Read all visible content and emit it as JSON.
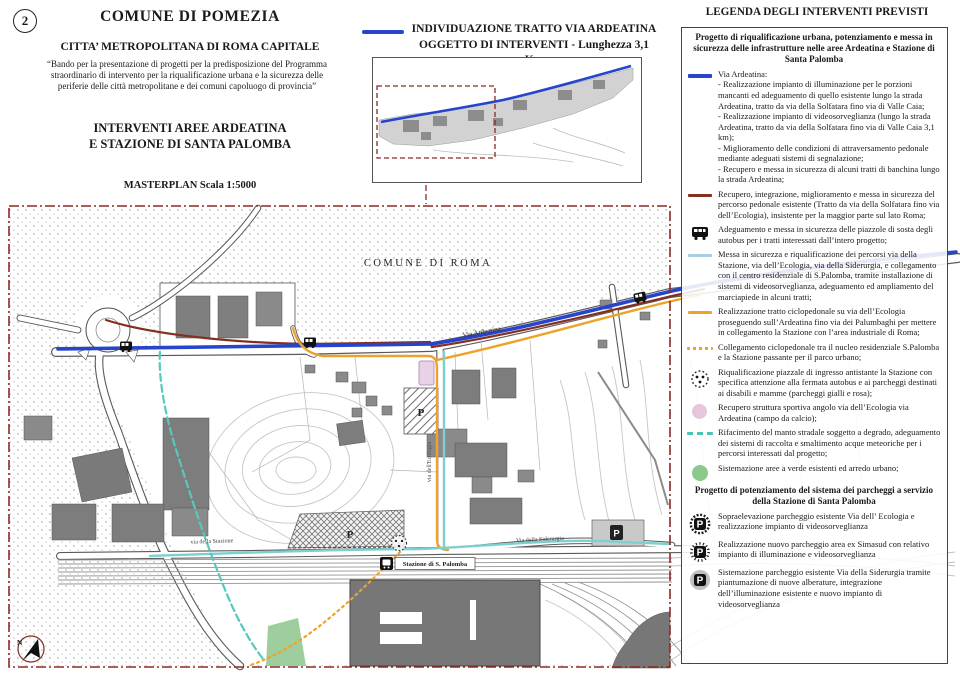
{
  "page": {
    "sheet_number": "2"
  },
  "title_block": {
    "title": "COMUNE DI POMEZIA",
    "subtitle": "CITTA’ METROPOLITANA DI ROMA CAPITALE",
    "quote": "“Bando per la presentazione di progetti per la predisposizione del Programma straordinario di intervento per la riqualificazione urbana e la sicurezza delle periferie delle città metropolitane e dei comuni capoluogo di provincia”",
    "heading_line1": "INTERVENTI  AREE ARDEATINA",
    "heading_line2": "E STAZIONE DI SANTA PALOMBA",
    "masterplan": "MASTERPLAN Scala 1:5000"
  },
  "inset": {
    "heading_line1": "INDIVIDUAZIONE TRATTO  VIA ARDEATINA",
    "heading_line2": "OGGETTO DI INTERVENTI - Lunghezza 3,1 Km"
  },
  "map_labels": {
    "comune_roma": "COMUNE DI ROMA",
    "via_ardeatina": "Via Ardeatina",
    "via_ecologia": "via dell'Ecologia",
    "via_siderurgia": "Via della Siderurgia",
    "via_stazione": "via della Stazione",
    "station": "Stazione di S. Palomba",
    "north": "N",
    "parking_p1": "P",
    "parking_p2": "P",
    "parking_p3": "P"
  },
  "legend": {
    "title": "LEGENDA DEGLI INTERVENTI PREVISTI",
    "section1_title": "Progetto di riqualificazione urbana, potenziamento e messa in sicurezza delle infrastrutture nelle aree Ardeatina e Stazione di Santa Palomba",
    "items": [
      {
        "icon": "blue-line",
        "label": "Via Ardeatina:",
        "subs": [
          "- Realizzazione impianto di illuminazione per le porzioni mancanti ed adeguamento di quello esistente lungo la strada Ardeatina, tratto da via della Solfatara fino via di Valle Caia;",
          "- Realizzazione impianto di videosorveglianza (lungo la strada Ardeatina, tratto da via della Solfatara fino via di Valle Caia 3,1 km);",
          "- Miglioramento delle condizioni di attraversamento pedonale mediante adeguati sistemi di segnalazione;",
          "- Recupero e messa in sicurezza di alcuni tratti di banchina lungo la strada Ardeatina;"
        ]
      },
      {
        "icon": "darkred-line",
        "text": "Recupero, integrazione, miglioramento e messa in sicurezza del percorso pedonale esistente (Tratto da via della Solfatara fino via dell’Ecologia), insistente per la maggior parte sul lato Roma;"
      },
      {
        "icon": "bus",
        "text": "Adeguamento e messa in sicurezza delle piazzole di sosta degli autobus per i tratti interessati dall’intero progetto;"
      },
      {
        "icon": "lightblue-line",
        "text": "Messa in sicurezza e riqualificazione dei percorsi via della Stazione, via dell’Ecologia, via della Siderurgia, e collegamento con il centro residenziale di S.Palomba, tramite installazione di sistemi di videosorveglianza, adeguamento ed ampliamento del marciapiede in alcuni tratti;"
      },
      {
        "icon": "orange-line",
        "text": "Realizzazione tratto ciclopedonale su via dell’Ecologia proseguendo sull’Ardeatina fino via dei Palumbaghi per mettere in collegamento la Stazione con l’area industriale di Roma;"
      },
      {
        "icon": "orange-dotted",
        "text": "Collegamento ciclopedonale tra il nucleo residenziale S.Palomba e la Stazione passante per il parco urbano;"
      },
      {
        "icon": "dotted-circle",
        "text": "Riqualificazione piazzale di ingresso antistante la Stazione con specifica attenzione alla fermata autobus e ai parcheggi destinati ai disabili e mamme (parcheggi gialli e rosa);"
      },
      {
        "icon": "pink-area",
        "text": "Recupero struttura sportiva angolo via dell’Ecologia via Ardeatina (campo da calcio);"
      },
      {
        "icon": "teal-dashed",
        "text": "Rifacimento del manto stradale soggetto a degrado, adeguamento dei sistemi di raccolta e smaltimento acque meteoriche per i percorsi interessati dal progetto;"
      },
      {
        "icon": "green-area",
        "text": "Sistemazione aree a verde esistenti ed arredo urbano;"
      }
    ],
    "section2_title": "Progetto di potenziamento del sistema dei parcheggi a servizio della Stazione di Santa Palomba",
    "items2": [
      {
        "icon": "p-hatched",
        "text": "Sopraelevazione parcheggio esistente Via dell’ Ecologia e realizzazione impianto di videosorveglianza"
      },
      {
        "icon": "p-gear",
        "text": "Realizzazione nuovo parcheggio area ex Simasud con relativo impianto di illuminazione e videosorveglianza"
      },
      {
        "icon": "p-plain",
        "text": "Sistemazione parcheggio esistente Via della Siderurgia tramite piantumazione di nuove alberature, integrazione dell’illuminazione esistente e nuovo impianto di videosorveglianza"
      }
    ]
  },
  "colors": {
    "ardeatina_blue": "#2545cc",
    "pedestrian_darkred": "#84301f",
    "paths_lightblue": "#7ecfcf",
    "cycle_orange": "#eda32b",
    "manto_teal": "#49c4b9",
    "border_dashed": "#8b2a1f",
    "sport_pink": "#e5c6dc",
    "green_area": "#8cc98c"
  }
}
